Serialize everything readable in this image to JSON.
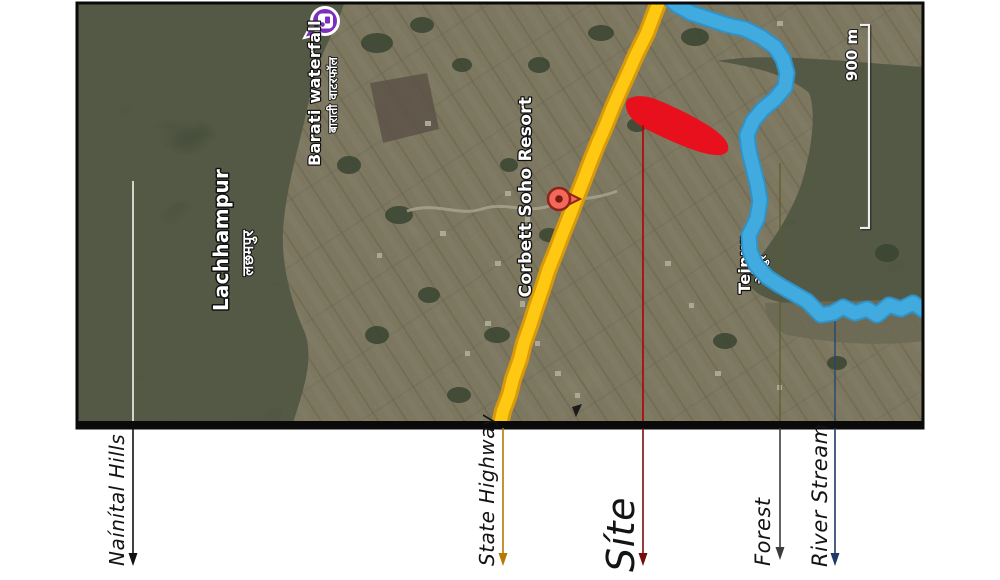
{
  "figure": {
    "type": "site-location-satellite-map",
    "orientation": "rotated-90-ccw"
  },
  "map": {
    "scale_bar": {
      "label": "900 m"
    },
    "places": [
      {
        "id": "lachhampur",
        "name": "Lachhampur",
        "name_local": "लछमपुर"
      },
      {
        "id": "barati-waterfall",
        "name": "Barati waterfall",
        "name_local": "बाराती वाटरफॉल"
      },
      {
        "id": "corbett-soho-resort",
        "name": "Corbett Soho Resort"
      },
      {
        "id": "tejpur",
        "name": "Tejpur",
        "name_local": "तेजपुर"
      }
    ],
    "features": {
      "highway_color": "#ffc913",
      "highway_casing_color": "#d8990a",
      "river_color": "#41abe0",
      "site_color": "#e8101c",
      "waterfall_pin_color": "#7b2fbe",
      "resort_pin_color": "#f3685a"
    }
  },
  "annotations": [
    {
      "label": "Naínítal Hills",
      "arrow_color": "#111111"
    },
    {
      "label": "State Highway",
      "arrow_color": "#b87700"
    },
    {
      "label": "Síte",
      "arrow_color": "#7a0b0b"
    },
    {
      "label": "Forest",
      "arrow_color": "#3c3c3c"
    },
    {
      "label": "River Stream",
      "arrow_color": "#1f3864"
    }
  ]
}
